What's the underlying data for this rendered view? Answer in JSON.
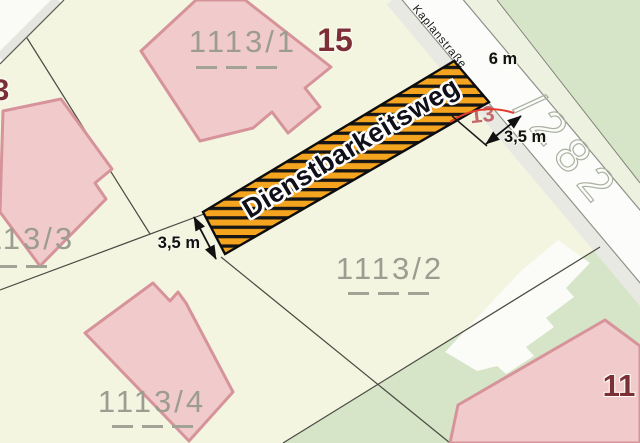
{
  "map": {
    "street": {
      "name": "Kaplanstraße",
      "width_label": "6 m"
    },
    "easement": {
      "label": "Dienstbarkeitsweg",
      "width_label_left": "3,5 m",
      "width_label_right": "3,5 m"
    },
    "parcels": {
      "p1": "1113/1",
      "p2": "1113/2",
      "p3": "1113/3",
      "p4": "1113/4",
      "p282": "/282"
    },
    "house_numbers": {
      "h15": "15",
      "h13": "13",
      "h11": "11",
      "h3": "3"
    },
    "colors": {
      "parcel_bg": "#f3f5e1",
      "green_area": "#d6e4c8",
      "building_fill": "#f1cbcc",
      "building_stroke": "#d6949a",
      "easement_orange": "#f5a41f",
      "easement_stripe": "#161616",
      "street_white": "#fcfcfa",
      "house_number": "#7d2f36",
      "parcel_label": "#9c9c90",
      "red_mark": "#e23b2e"
    }
  }
}
